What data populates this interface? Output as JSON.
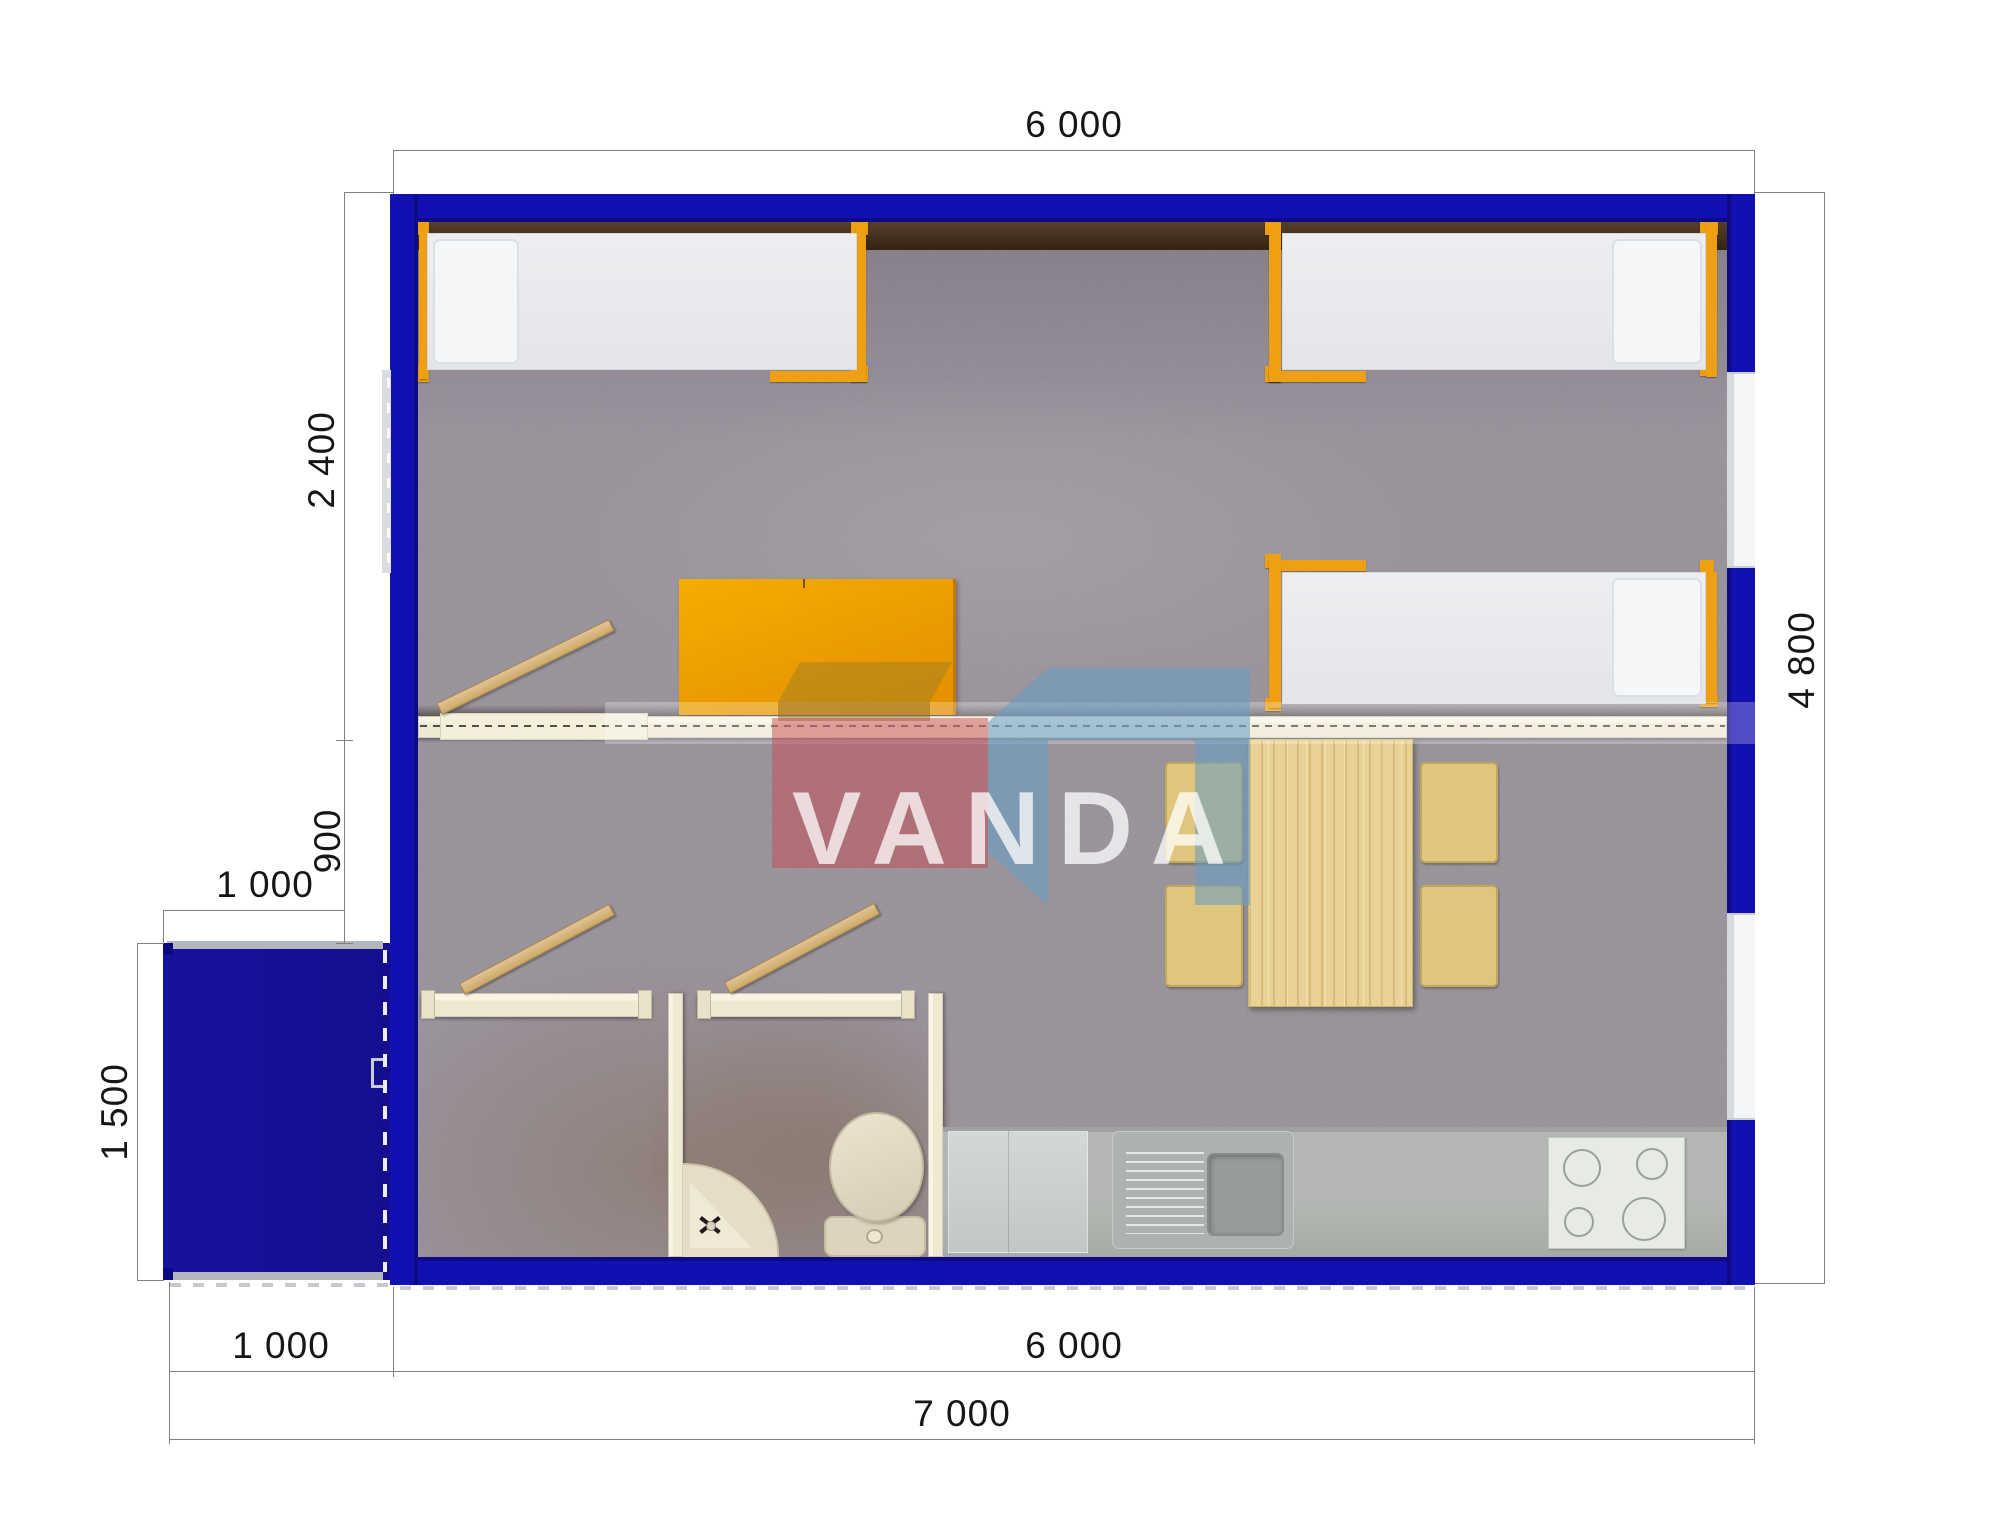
{
  "meta": {
    "type": "floor-plan-top-view",
    "brand": "VANDA"
  },
  "watermark": {
    "text": "VANDA"
  },
  "dimensions": {
    "top_width": "6 000",
    "room_depth_left": "2 400",
    "hall_depth_left": "900",
    "annex_width_top": "1 000",
    "annex_height_left": "1 500",
    "annex_width_bottom": "1 000",
    "building_width_bottom": "6 000",
    "total_width_bottom": "7 000",
    "building_height_right": "4 800"
  },
  "inventory": {
    "single_beds": 3,
    "pillows": 3,
    "orange_cabinet_table": 1,
    "dining_table": 1,
    "chairs": 4,
    "toilet": 1,
    "corner_sink": 1,
    "kitchen_counter": 1,
    "kitchen_sink_with_drainer": 1,
    "stove_burners": 4,
    "entry_porch": 1,
    "windows": 3,
    "open_door_leaves": 3,
    "dashed_entry_door": 1
  },
  "colors": {
    "wall_blue": "#1310b2",
    "wall_blue_dark": "#0d0a85",
    "dim_line": "#7f7f7f",
    "dim_text": "#161616",
    "cream_wall": "#efe9d2",
    "carpet": "#a29ca4",
    "carpet_brown_tint": "#7d5f42",
    "dark_ledge": "#3f2d1e",
    "bed_frame_orange": "#eea012",
    "table_orange": "#f2a300",
    "pine_wood": "#e9d296",
    "chair_tan": "#dfc67c",
    "counter_gray": "#b3b6b2",
    "stove_white": "#e8eae6",
    "fixture_cream": "#e3dac5",
    "logo_red": "rgba(198,75,82,0.55)",
    "logo_blue": "rgba(105,158,195,0.58)",
    "logo_olive": "rgba(160,125,35,0.55)",
    "watermark_text": "rgba(255,255,255,0.75)"
  }
}
